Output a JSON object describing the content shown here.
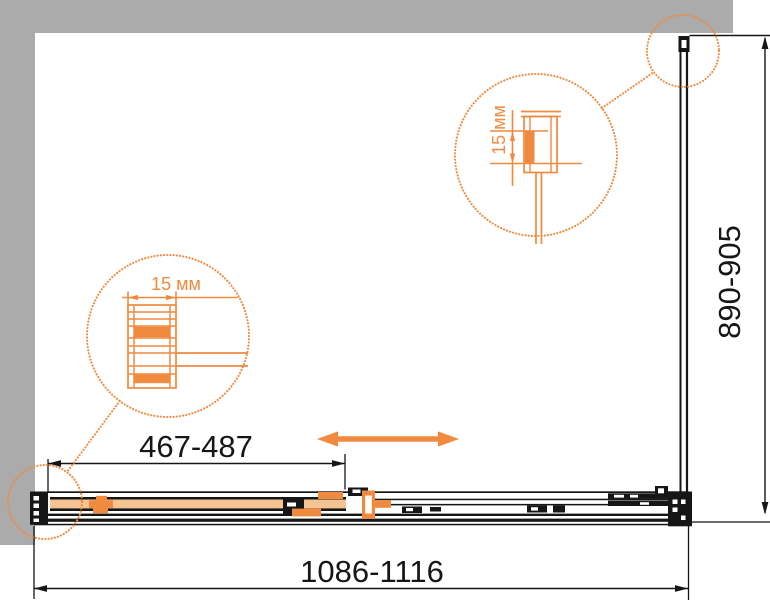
{
  "labels": {
    "width": "1086-1116",
    "panel": "467-487",
    "height": "890-905",
    "detail_left": "15 мм",
    "detail_top": "15 мм"
  },
  "colors": {
    "ink": "#161616",
    "orange": "#ef8a3e",
    "glass": "#f6c493",
    "wall": "#ababab",
    "bg": "#ffffff"
  },
  "icons": {
    "slide_arrow": "double-headed-horizontal-arrow",
    "detail_circles": "dotted-magnifier-callout-circle"
  }
}
